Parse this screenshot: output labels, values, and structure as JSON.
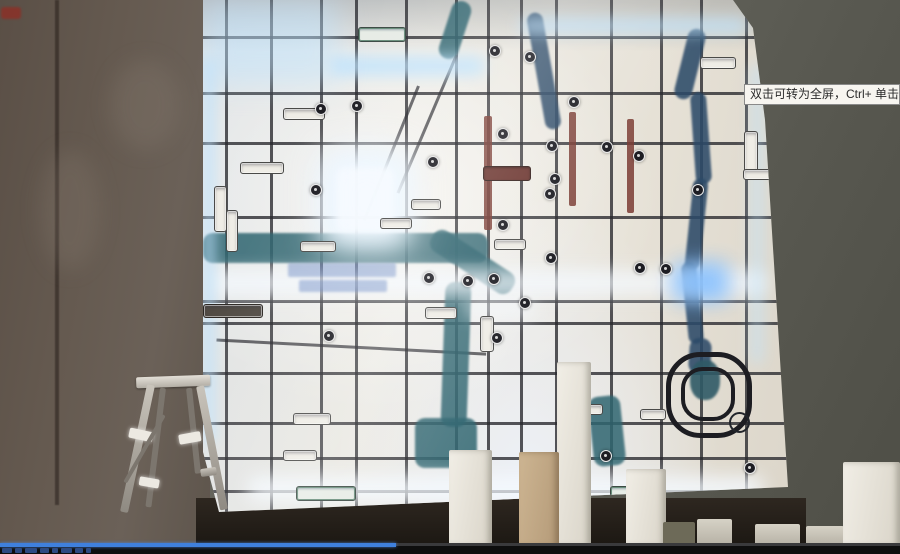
{
  "tooltip": {
    "text": "双击可转为全屏，Ctrl+ 单击可转为"
  },
  "video_player": {
    "progress_percent": 44,
    "progress_color": "#3f80dd",
    "title_blob_widths": [
      10,
      7,
      12,
      9,
      6,
      11,
      8,
      5
    ]
  },
  "colors": {
    "wall_left": "#5b5149",
    "wall_right": "#63635b",
    "map_base": "#e9e7e0",
    "road": "#26262c",
    "river_teal": "#2f6570",
    "river_blue": "#2c4a68",
    "led_glow": "#cfeaff",
    "tooltip_bg": "#f7f5f0",
    "progress_blue": "#3f80dd"
  },
  "map_wall": {
    "roads_vertical_x": [
      22,
      67,
      117,
      152,
      202,
      252,
      284,
      317,
      352,
      407,
      457,
      497,
      542
    ],
    "roads_horizontal_y": [
      36,
      92,
      142,
      216,
      300,
      322,
      372,
      422,
      457,
      490
    ],
    "roads_diagonal": [
      {
        "x": 214,
        "y": 86,
        "len": 145,
        "rot": 22
      },
      {
        "x": 252,
        "y": 55,
        "len": 150,
        "rot": 23
      },
      {
        "x": 12,
        "y": 340,
        "len": 270,
        "rot": -87
      }
    ],
    "rivers": [
      {
        "x": 333,
        "y": 12,
        "w": 16,
        "h": 118,
        "rot": -10,
        "v": "blue"
      },
      {
        "x": 478,
        "y": 28,
        "w": 18,
        "h": 72,
        "rot": 14,
        "v": "blue"
      },
      {
        "x": 490,
        "y": 92,
        "w": 16,
        "h": 92,
        "rot": -4,
        "v": "blue"
      },
      {
        "x": 486,
        "y": 178,
        "w": 15,
        "h": 92,
        "rot": 6,
        "v": "blue"
      },
      {
        "x": 482,
        "y": 262,
        "w": 15,
        "h": 82,
        "rot": -6,
        "v": "blue"
      },
      {
        "x": 486,
        "y": 338,
        "w": 22,
        "h": 36,
        "rot": 4,
        "v": "blue"
      },
      {
        "x": 0,
        "y": 233,
        "w": 285,
        "h": 30,
        "rot": 0,
        "v": "teal"
      },
      {
        "x": 222,
        "y": 250,
        "w": 95,
        "h": 24,
        "rot": 33,
        "v": "teal"
      },
      {
        "x": 240,
        "y": 282,
        "w": 26,
        "h": 145,
        "rot": 2,
        "v": "teal"
      },
      {
        "x": 212,
        "y": 418,
        "w": 62,
        "h": 50,
        "rot": 0,
        "v": "teal"
      },
      {
        "x": 388,
        "y": 396,
        "w": 32,
        "h": 70,
        "rot": -6,
        "v": "teal"
      },
      {
        "x": 242,
        "y": 0,
        "w": 20,
        "h": 60,
        "rot": 18,
        "v": "teal"
      }
    ],
    "glows": [
      {
        "x": 134,
        "y": 168,
        "w": 57,
        "h": 64,
        "blur": 3,
        "op": 1,
        "c": "white",
        "core": true
      },
      {
        "x": 118,
        "y": 148,
        "w": 92,
        "h": 102,
        "blur": 18,
        "op": 0.7,
        "c": "white"
      },
      {
        "x": 127,
        "y": 56,
        "w": 155,
        "h": 20,
        "blur": 7,
        "op": 0.8,
        "c": "cyan"
      },
      {
        "x": 8,
        "y": 270,
        "w": 556,
        "h": 26,
        "blur": 8,
        "op": 0.75,
        "c": "white"
      },
      {
        "x": 470,
        "y": 262,
        "w": 56,
        "h": 40,
        "blur": 10,
        "op": 0.9,
        "c": "blue"
      },
      {
        "x": 45,
        "y": 477,
        "w": 515,
        "h": 24,
        "blur": 9,
        "op": 0.9,
        "c": "white"
      },
      {
        "x": 0,
        "y": 58,
        "w": 12,
        "h": 386,
        "blur": 6,
        "op": 0.7,
        "c": "cyan"
      },
      {
        "x": 316,
        "y": 18,
        "w": 228,
        "h": 16,
        "blur": 7,
        "op": 0.7,
        "c": "cyan"
      },
      {
        "x": 548,
        "y": 64,
        "w": 12,
        "h": 300,
        "blur": 7,
        "op": 0.55,
        "c": "cyan"
      },
      {
        "x": 0,
        "y": 0,
        "w": 135,
        "h": 85,
        "blur": 14,
        "op": 0.5,
        "c": "cyan"
      },
      {
        "x": 262,
        "y": 300,
        "w": 70,
        "h": 18,
        "blur": 8,
        "op": 0.6,
        "c": "white"
      }
    ],
    "poi_markers": [
      [
        286,
        45
      ],
      [
        321,
        51
      ],
      [
        112,
        103
      ],
      [
        148,
        100
      ],
      [
        224,
        156
      ],
      [
        294,
        128
      ],
      [
        343,
        140
      ],
      [
        346,
        173
      ],
      [
        398,
        141
      ],
      [
        430,
        150
      ],
      [
        489,
        184
      ],
      [
        341,
        188
      ],
      [
        294,
        219
      ],
      [
        107,
        184
      ],
      [
        220,
        272
      ],
      [
        259,
        275
      ],
      [
        285,
        273
      ],
      [
        316,
        297
      ],
      [
        288,
        332
      ],
      [
        397,
        450
      ],
      [
        541,
        462
      ],
      [
        457,
        263
      ],
      [
        431,
        262
      ],
      [
        342,
        252
      ],
      [
        365,
        96
      ],
      [
        120,
        330
      ]
    ],
    "label_chips": [
      {
        "x": 155,
        "y": 27,
        "w": 46,
        "h": 13,
        "v": "hw"
      },
      {
        "x": 80,
        "y": 108,
        "w": 40,
        "h": 10,
        "v": "plain"
      },
      {
        "x": 37,
        "y": 162,
        "w": 42,
        "h": 10,
        "v": "plain"
      },
      {
        "x": 177,
        "y": 218,
        "w": 30,
        "h": 9,
        "v": "plain"
      },
      {
        "x": 97,
        "y": 241,
        "w": 34,
        "h": 9,
        "v": "plain"
      },
      {
        "x": 0,
        "y": 304,
        "w": 58,
        "h": 12,
        "v": "dark"
      },
      {
        "x": 222,
        "y": 307,
        "w": 30,
        "h": 10,
        "v": "plain"
      },
      {
        "x": 277,
        "y": 316,
        "w": 12,
        "h": 34,
        "v": "plain"
      },
      {
        "x": 90,
        "y": 413,
        "w": 36,
        "h": 10,
        "v": "plain"
      },
      {
        "x": 80,
        "y": 450,
        "w": 32,
        "h": 9,
        "v": "plain"
      },
      {
        "x": 93,
        "y": 486,
        "w": 58,
        "h": 13,
        "v": "hw"
      },
      {
        "x": 407,
        "y": 486,
        "w": 44,
        "h": 12,
        "v": "hw"
      },
      {
        "x": 541,
        "y": 131,
        "w": 12,
        "h": 42,
        "v": "plain"
      },
      {
        "x": 11,
        "y": 186,
        "w": 11,
        "h": 44,
        "v": "plain"
      },
      {
        "x": 23,
        "y": 210,
        "w": 10,
        "h": 40,
        "v": "plain"
      },
      {
        "x": 280,
        "y": 166,
        "w": 46,
        "h": 13,
        "v": "maroon"
      },
      {
        "x": 208,
        "y": 199,
        "w": 28,
        "h": 9,
        "v": "plain"
      },
      {
        "x": 291,
        "y": 239,
        "w": 30,
        "h": 9,
        "v": "plain"
      },
      {
        "x": 372,
        "y": 404,
        "w": 26,
        "h": 9,
        "v": "plain"
      },
      {
        "x": 437,
        "y": 409,
        "w": 24,
        "h": 9,
        "v": "plain"
      },
      {
        "x": 497,
        "y": 57,
        "w": 34,
        "h": 10,
        "v": "plain"
      },
      {
        "x": 540,
        "y": 169,
        "w": 32,
        "h": 9,
        "v": "plain"
      }
    ],
    "metro_bars": [
      {
        "x": 281,
        "y": 116,
        "w": 8,
        "h": 114
      },
      {
        "x": 366,
        "y": 112,
        "w": 7,
        "h": 94
      },
      {
        "x": 424,
        "y": 119,
        "w": 7,
        "h": 94
      }
    ],
    "watermark_rows": [
      {
        "x": 85,
        "y": 263,
        "w": 108,
        "h": 14
      },
      {
        "x": 96,
        "y": 280,
        "w": 88,
        "h": 12
      }
    ],
    "ring_feature": {
      "x": 463,
      "y": 352,
      "outer": 76,
      "inner": 46,
      "blob": {
        "x": 487,
        "y": 360,
        "w": 30,
        "h": 40
      }
    },
    "ring_small": {
      "x": 526,
      "y": 412,
      "d": 17
    }
  },
  "ladder": {
    "parts": [
      {
        "x": 136,
        "y": 376,
        "w": 74,
        "h": 11,
        "rot": -2,
        "t": "bright"
      },
      {
        "x": 147,
        "y": 385,
        "w": 8,
        "h": 130,
        "rot": 12,
        "t": "mid"
      },
      {
        "x": 196,
        "y": 386,
        "w": 8,
        "h": 126,
        "rot": -11,
        "t": "mid"
      },
      {
        "x": 160,
        "y": 388,
        "w": 6,
        "h": 120,
        "rot": 7,
        "t": "dark"
      },
      {
        "x": 186,
        "y": 388,
        "w": 6,
        "h": 86,
        "rot": -6,
        "t": "dark"
      },
      {
        "x": 130,
        "y": 430,
        "w": 24,
        "h": 10,
        "rot": 12,
        "t": "glint"
      },
      {
        "x": 178,
        "y": 433,
        "w": 22,
        "h": 10,
        "rot": -10,
        "t": "glint"
      },
      {
        "x": 140,
        "y": 478,
        "w": 20,
        "h": 9,
        "rot": 10,
        "t": "glint"
      },
      {
        "x": 200,
        "y": 468,
        "w": 16,
        "h": 8,
        "rot": -8,
        "t": "mid"
      },
      {
        "x": 162,
        "y": 415,
        "w": 4,
        "h": 78,
        "rot": 30,
        "t": "dark"
      }
    ]
  },
  "objects": {
    "boxes": [
      {
        "x": 557,
        "y": 362,
        "w": 34,
        "h": 184,
        "t": "white"
      },
      {
        "x": 449,
        "y": 450,
        "w": 43,
        "h": 96,
        "t": "white"
      },
      {
        "x": 519,
        "y": 452,
        "w": 40,
        "h": 94,
        "t": "tan"
      },
      {
        "x": 626,
        "y": 469,
        "w": 40,
        "h": 77,
        "t": "white"
      },
      {
        "x": 663,
        "y": 522,
        "w": 32,
        "h": 24,
        "t": "olive"
      },
      {
        "x": 697,
        "y": 519,
        "w": 35,
        "h": 27,
        "t": "dim"
      },
      {
        "x": 755,
        "y": 524,
        "w": 45,
        "h": 22,
        "t": "dim"
      },
      {
        "x": 806,
        "y": 526,
        "w": 38,
        "h": 20,
        "t": "dim"
      },
      {
        "x": 843,
        "y": 462,
        "w": 57,
        "h": 84,
        "t": "white"
      }
    ]
  }
}
